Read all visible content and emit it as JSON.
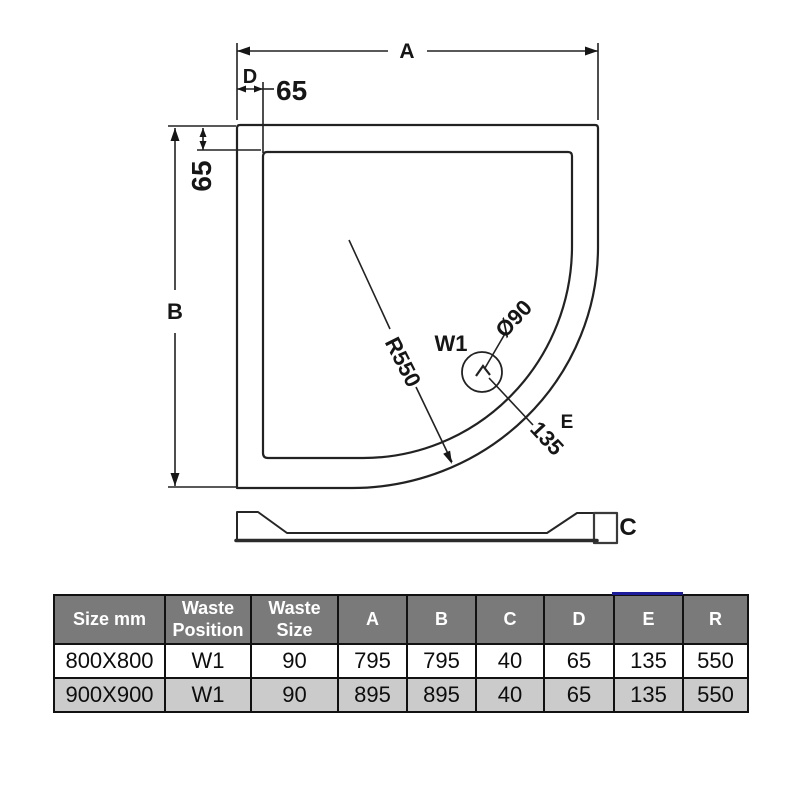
{
  "colors": {
    "line": "#222222",
    "table_header_bg": "#7a7a7a",
    "table_header_text": "#ffffff",
    "table_alt_row_bg": "#cbcbcb",
    "table_border": "#111111",
    "e_column_highlight": "#1b1b9c",
    "c_label_blue": "#3f63c0"
  },
  "diagram": {
    "plan": {
      "dim_a_label": "A",
      "dim_b_label": "B",
      "dim_d_label": "D",
      "dim_d_value": "65",
      "edge_inset_value": "65",
      "radius_label": "R550",
      "waste_position_label": "W1",
      "waste_diameter_label": "Ø90",
      "dim_e_label": "E",
      "dim_e_value": "135"
    },
    "profile": {
      "height_label": "C"
    }
  },
  "table": {
    "headers": [
      "Size mm",
      "Waste Position",
      "Waste Size",
      "A",
      "B",
      "C",
      "D",
      "E",
      "R"
    ],
    "rows": [
      [
        "800X800",
        "W1",
        "90",
        "795",
        "795",
        "40",
        "65",
        "135",
        "550"
      ],
      [
        "900X900",
        "W1",
        "90",
        "895",
        "895",
        "40",
        "65",
        "135",
        "550"
      ]
    ]
  }
}
